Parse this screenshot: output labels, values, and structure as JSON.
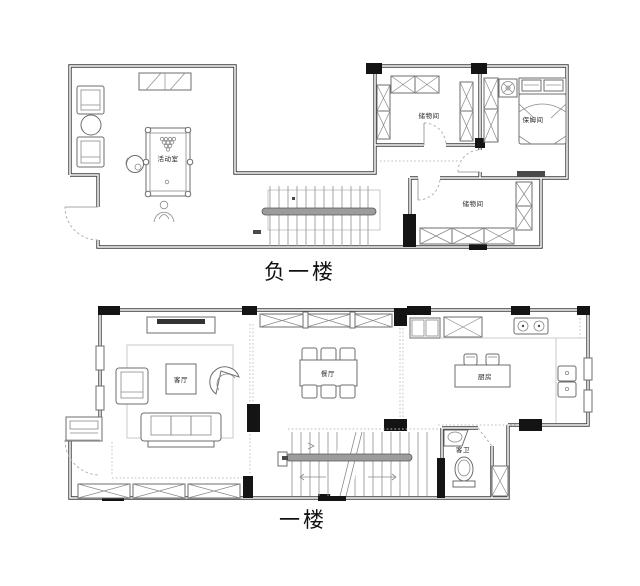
{
  "title": "两层住宅平面图",
  "colors": {
    "wall": "#3b3b3b",
    "furniture": "#6e6e6e",
    "column": "#141414",
    "background": "#ffffff",
    "label_text": "#222222"
  },
  "floors": [
    {
      "name": "负一楼",
      "rooms": [
        {
          "label": "活动室"
        },
        {
          "label": "储物间"
        },
        {
          "label": "保姆间"
        },
        {
          "label": "储物间"
        }
      ]
    },
    {
      "name": "一楼",
      "rooms": [
        {
          "label": "客厅"
        },
        {
          "label": "餐厅"
        },
        {
          "label": "厨房"
        },
        {
          "label": "客卫"
        }
      ]
    }
  ]
}
